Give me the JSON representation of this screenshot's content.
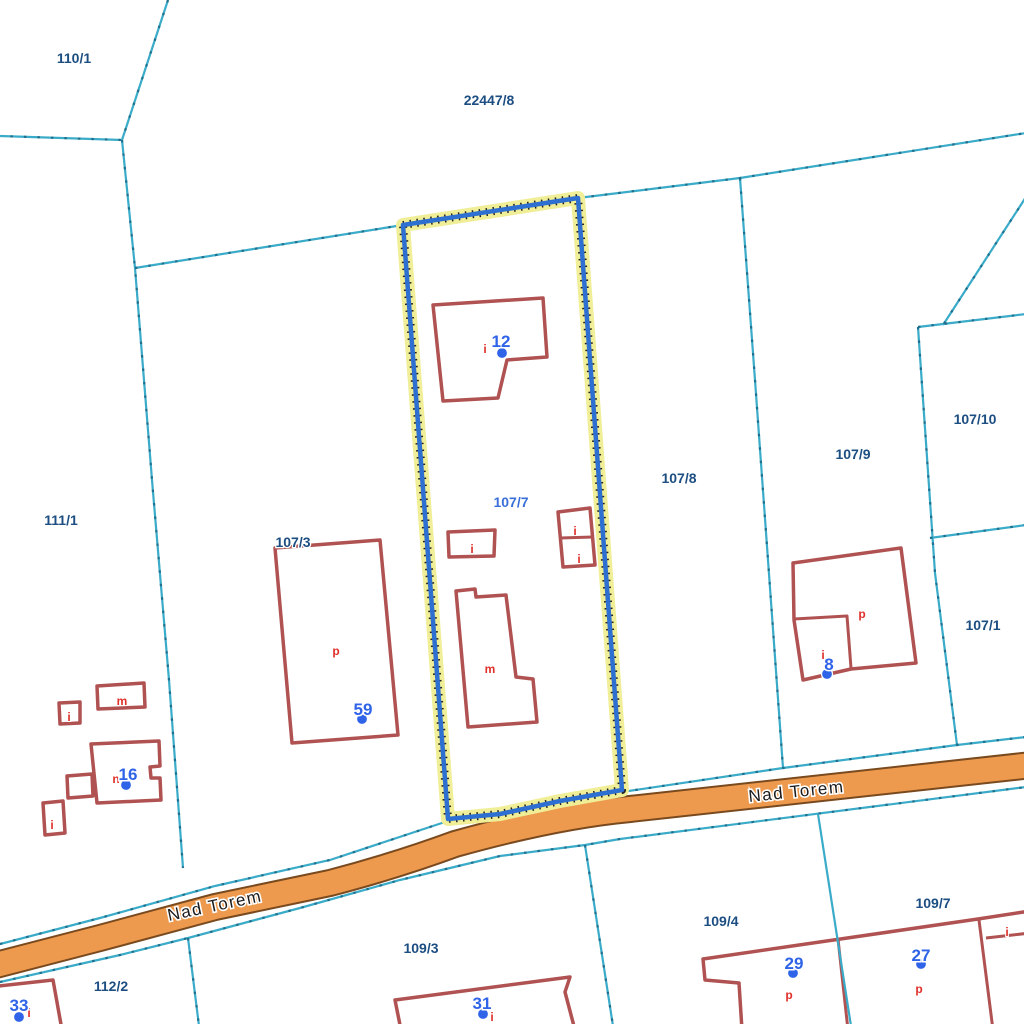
{
  "map": {
    "street": {
      "name": "Nad Torem",
      "labels": [
        {
          "x": 797,
          "y": 797,
          "angle": -6
        },
        {
          "x": 216,
          "y": 911,
          "angle": -12
        }
      ]
    },
    "parcel_labels": [
      {
        "text": "110/1",
        "x": 74,
        "y": 58
      },
      {
        "text": "22447/8",
        "x": 489,
        "y": 100
      },
      {
        "text": "111/1",
        "x": 61,
        "y": 520
      },
      {
        "text": "107/3",
        "x": 293,
        "y": 542
      },
      {
        "text": "107/7",
        "x": 511,
        "y": 502,
        "selected": true
      },
      {
        "text": "107/8",
        "x": 679,
        "y": 478
      },
      {
        "text": "107/9",
        "x": 853,
        "y": 454
      },
      {
        "text": "107/10",
        "x": 975,
        "y": 419
      },
      {
        "text": "107/1",
        "x": 983,
        "y": 625
      },
      {
        "text": "112/2",
        "x": 111,
        "y": 986
      },
      {
        "text": "109/3",
        "x": 421,
        "y": 948
      },
      {
        "text": "109/4",
        "x": 721,
        "y": 921
      },
      {
        "text": "109/7",
        "x": 933,
        "y": 903
      }
    ],
    "house_numbers": [
      {
        "text": "12",
        "x": 501,
        "y": 347,
        "dot": {
          "x": 502,
          "y": 353
        }
      },
      {
        "text": "59",
        "x": 363,
        "y": 715,
        "dot": {
          "x": 362,
          "y": 719
        }
      },
      {
        "text": "16",
        "x": 128,
        "y": 780,
        "dot": {
          "x": 126,
          "y": 785
        }
      },
      {
        "text": "8",
        "x": 829,
        "y": 670,
        "dot": {
          "x": 827,
          "y": 674
        }
      },
      {
        "text": "33",
        "x": 19,
        "y": 1011,
        "dot": {
          "x": 19,
          "y": 1017
        }
      },
      {
        "text": "31",
        "x": 482,
        "y": 1009,
        "dot": {
          "x": 483,
          "y": 1014
        }
      },
      {
        "text": "29",
        "x": 794,
        "y": 969,
        "dot": {
          "x": 793,
          "y": 973
        }
      },
      {
        "text": "27",
        "x": 921,
        "y": 961,
        "dot": {
          "x": 921,
          "y": 964
        }
      }
    ],
    "building_letters": [
      {
        "text": "i",
        "x": 485,
        "y": 349
      },
      {
        "text": "i",
        "x": 472,
        "y": 549
      },
      {
        "text": "i",
        "x": 575,
        "y": 531
      },
      {
        "text": "i",
        "x": 579,
        "y": 559
      },
      {
        "text": "m",
        "x": 490,
        "y": 669
      },
      {
        "text": "p",
        "x": 336,
        "y": 651
      },
      {
        "text": "m",
        "x": 122,
        "y": 701
      },
      {
        "text": "i",
        "x": 69,
        "y": 717
      },
      {
        "text": "n",
        "x": 116,
        "y": 779
      },
      {
        "text": "i",
        "x": 52,
        "y": 825
      },
      {
        "text": "p",
        "x": 862,
        "y": 614
      },
      {
        "text": "i",
        "x": 823,
        "y": 655
      },
      {
        "text": "p",
        "x": 789,
        "y": 995
      },
      {
        "text": "p",
        "x": 919,
        "y": 989
      },
      {
        "text": "i",
        "x": 1007,
        "y": 932
      },
      {
        "text": "i",
        "x": 29,
        "y": 1013
      },
      {
        "text": "i",
        "x": 492,
        "y": 1017
      }
    ],
    "colors": {
      "boundary": "#3aabc8",
      "parcel-label": "#1d4e82",
      "selected-label": "#3a6fd8",
      "highlight": "#2e6fd2",
      "highlight-halo": "#f0ee96",
      "building": "#b05252",
      "road-fill": "#ee9a4e",
      "road-border": "#7a4a1f",
      "marker": "#2f63e8",
      "letter": "#e0302a"
    }
  }
}
